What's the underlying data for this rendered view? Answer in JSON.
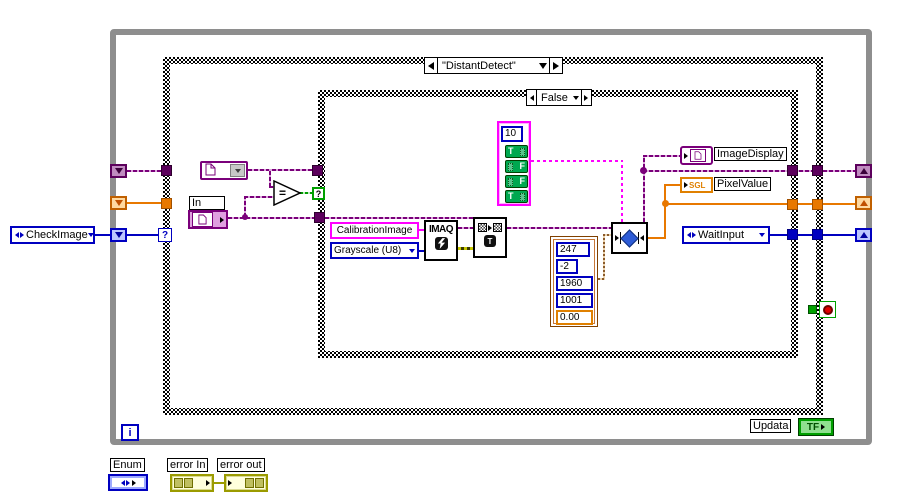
{
  "loop": {
    "iteration_label": "i"
  },
  "outer_case": {
    "label": "\"DistantDetect\"",
    "selector_glyph": "?"
  },
  "inner_case": {
    "label": "False",
    "selector_glyph": "?"
  },
  "left": {
    "checkimage_label": "CheckImage"
  },
  "file": {
    "in_label": "In",
    "equals_glyph": "="
  },
  "array_const": {
    "index": "10",
    "items": [
      {
        "value": "T"
      },
      {
        "value": "F"
      },
      {
        "value": "F"
      },
      {
        "value": "T"
      }
    ]
  },
  "consts": {
    "calibration": "CalibrationImage",
    "grayscale": "Grayscale (U8)"
  },
  "nodes": {
    "imaq_title": "IMAQ",
    "readfile_glyph": "T"
  },
  "cluster": {
    "values": [
      "247",
      "-2",
      "1960",
      "1001",
      "0.00"
    ]
  },
  "right": {
    "image_display": "ImageDisplay",
    "pixel_value": "PixelValue",
    "sgl": "SGL",
    "wait_input": "WaitInput"
  },
  "bottom": {
    "updata_label": "Updata",
    "tf": "TF",
    "enum_label": "Enum",
    "error_in": "error In",
    "error_out": "error out"
  },
  "colors": {
    "loop_border": "#8E8E8E",
    "image_purple": "#7A007A",
    "orange": "#E87800",
    "blue": "#0000C0",
    "magenta": "#FF00FF",
    "bool_green": "#00A850",
    "error_olive": "#9B9B00",
    "cluster_brown": "#8A5A2A"
  }
}
